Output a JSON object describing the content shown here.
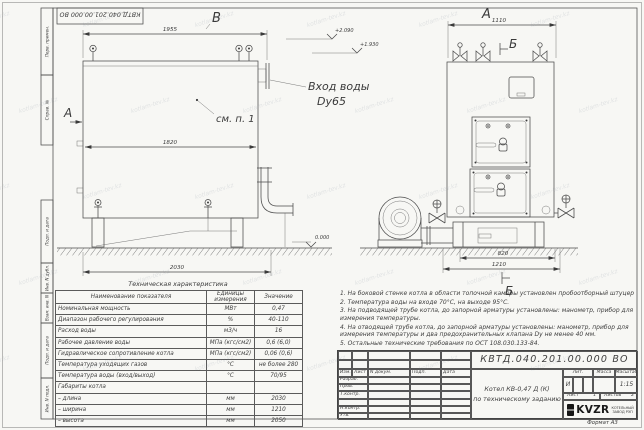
{
  "watermark": {
    "text": "kotlam-tev.kz"
  },
  "frame": {
    "top_stamp": "КВТД.040.201.00.000  ВО",
    "margin_labels": [
      "Перв. примен.",
      "Справ. №",
      "Подп. и дата",
      "Инв. N дубл.",
      "Взам. инв. N",
      "Подп. и дата",
      "Инв. N подл."
    ]
  },
  "views": {
    "left": {
      "label": "В",
      "dim_top": "1955",
      "dim_inner": "1820",
      "dim_bottom": "2030",
      "arrow_label": "А",
      "callout": "см. п. 1",
      "inlet_line1": "Вход воды",
      "inlet_line2": "Dy65",
      "elev_high": "+2.090",
      "elev_mid": "+1.930",
      "elev_zero": "0.000"
    },
    "right": {
      "label": "А",
      "dim_top": "1110",
      "dim_base": "820",
      "dim_bottom": "1210",
      "section_top": "Б",
      "section_bottom": "Б"
    }
  },
  "notes": [
    "1.  На боковой стенке котла в области топочной камеры установлен пробоотборный штуцер",
    "2.  Температура воды на входе 70°С, на выходе 95°С.",
    "3.  На подводящей трубе котла, до запорной арматуры установлены: манометр, прибор для измерения температуры.",
    "4.  На отводящей трубе котла, до запорной арматуры установлены: манометр, прибор для измерения температуры и два предохранительных клапана  Dу не менее 40 мм.",
    "5.  Остальные технические требования по ОСТ 108.030.133-84."
  ],
  "spec_table": {
    "title": "Техническая характеристика",
    "headers": [
      "Наименование показателя",
      "Единицы измерения",
      "Значение"
    ],
    "rows": [
      [
        "Номинальная мощность",
        "МВт",
        "0,47"
      ],
      [
        "Диапазон рабочего регулирования",
        "%",
        "40-110"
      ],
      [
        "Расход воды",
        "м3/ч",
        "16"
      ],
      [
        "Рабочее давление воды",
        "МПа (кгс/см2)",
        "0,6 (6,0)"
      ],
      [
        "Гидравлическое сопротивление котла",
        "МПа (кгс/см2)",
        "0,06 (0,6)"
      ],
      [
        "Температура уходящих газов",
        "°С",
        "не более 280"
      ],
      [
        "Температура воды (вход/выход)",
        "°С",
        "70/95"
      ],
      [
        "Габариты котла",
        "",
        ""
      ],
      [
        "   – длина",
        "мм",
        "2030"
      ],
      [
        "   – ширина",
        "мм",
        "1210"
      ],
      [
        "   – высота",
        "мм",
        "2050"
      ]
    ]
  },
  "title_block": {
    "doc_number": "КВТД.040.201.00.000  ВО",
    "product_line1": "Котел  КВ-0,47 Д (К)",
    "product_line2": "по техническому заданию",
    "header_cols": [
      "Изм.",
      "Лист",
      "N докум.",
      "Подп.",
      "Дата"
    ],
    "sign_rows": [
      "Разраб.",
      "Пров.",
      "Т.контр.",
      "",
      "Н.контр.",
      "Утв."
    ],
    "lit_cols": [
      "Лит.",
      "Масса",
      "Масштаб"
    ],
    "lit_value": "И",
    "scale": "1:15",
    "sheet_label": "Лист",
    "sheet_no": "1",
    "sheets_label": "Листов",
    "sheets_total": "2",
    "logo_text": "KVZR",
    "logo_sub1": "КОТЕЛЬНЫЙ",
    "logo_sub2": "ЗАВОД РЭП",
    "format_label": "Формат  А3"
  }
}
